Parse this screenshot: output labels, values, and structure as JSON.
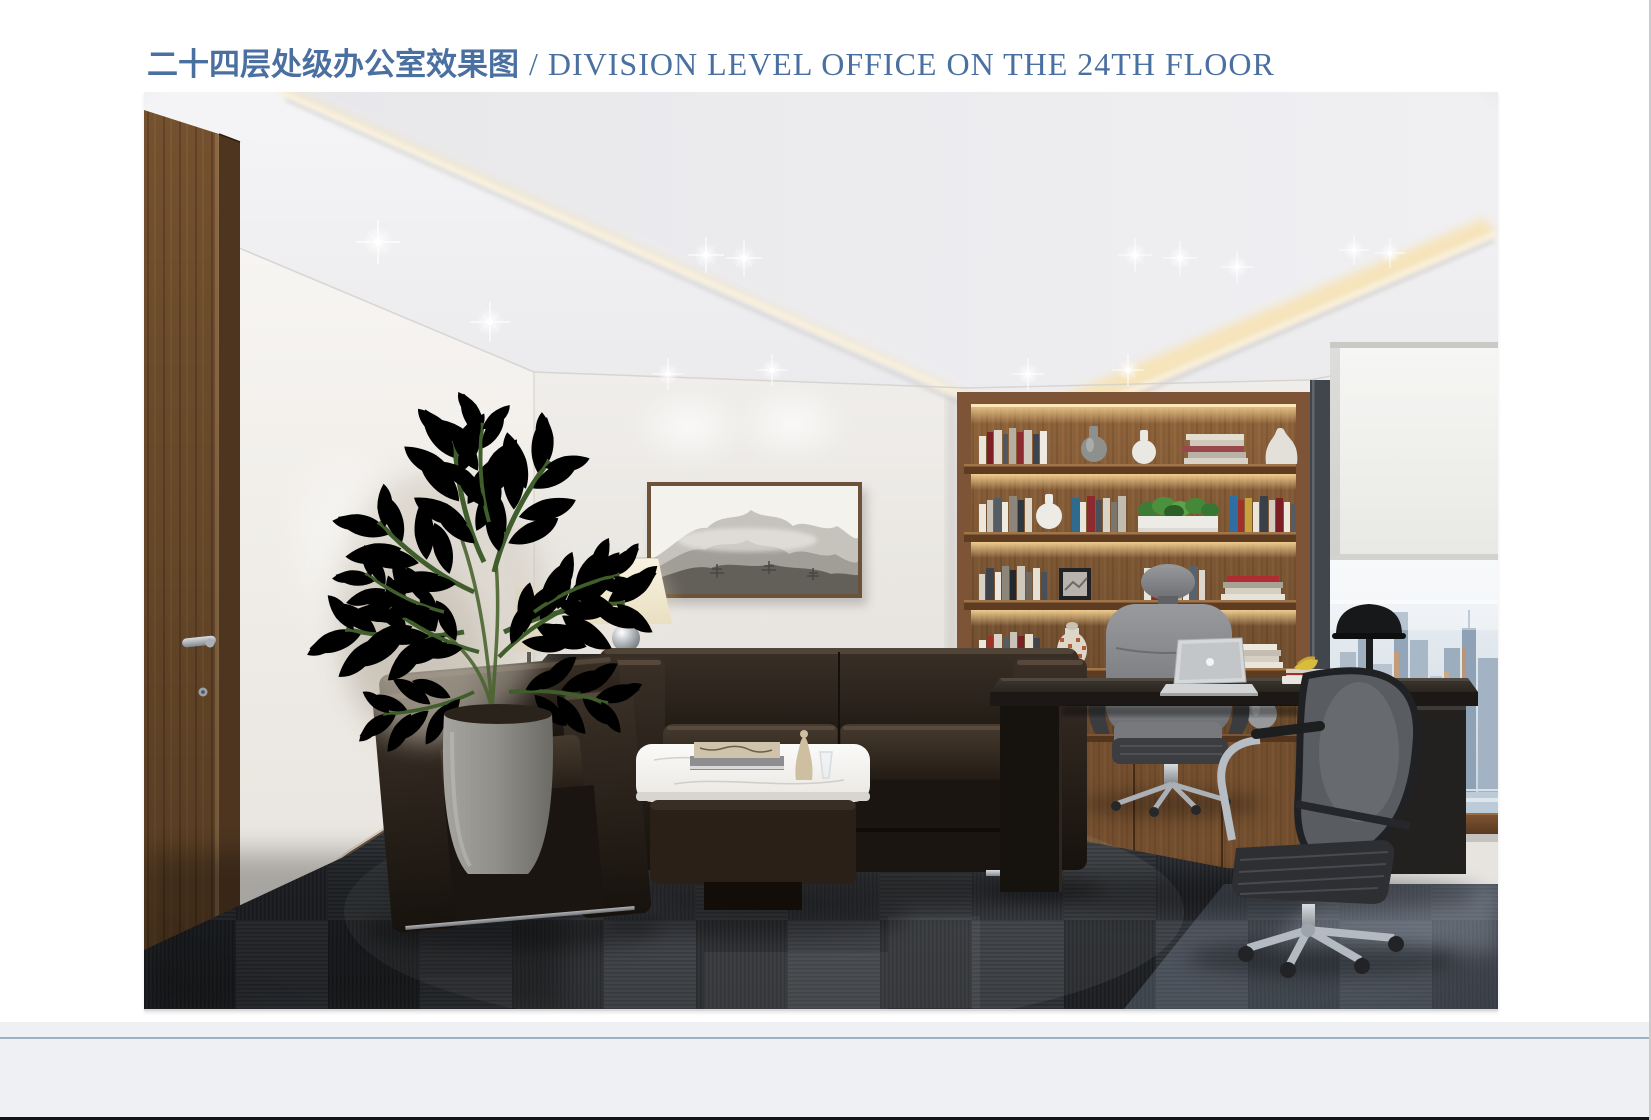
{
  "header": {
    "title_zh": "二十四层处级办公室效果图",
    "title_en": "/ DIVISION LEVEL OFFICE ON THE 24TH FLOOR"
  },
  "colors": {
    "title": "#4a6fa1",
    "page_bg": "#ffffff",
    "footer_bg": "#eef0f3",
    "footer_line": "#9db1c5",
    "bottom_bar": "#141414",
    "edge_line": "#c9cbcd"
  }
}
